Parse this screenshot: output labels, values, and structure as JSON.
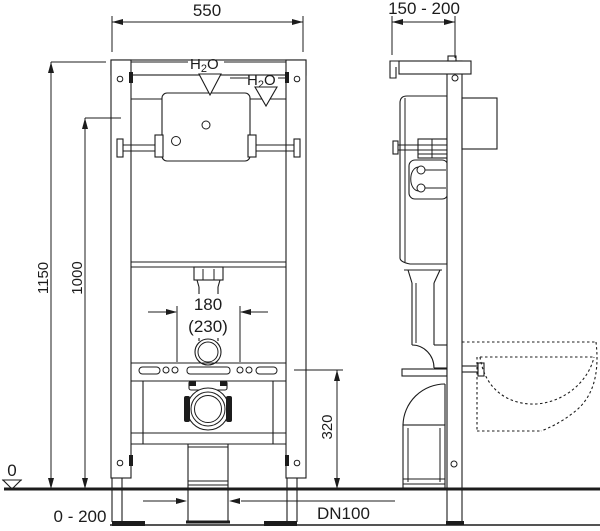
{
  "meta": {
    "title": "Wall-mounted WC concealed installation frame - dimensioned technical drawing (front and side view)"
  },
  "colors": {
    "line": "#1c1c1c",
    "background": "#ffffff"
  },
  "labels": {
    "front_width": "550",
    "side_depth": "150 - 200",
    "frame_height": "1150",
    "upper_fixing_height": "1000",
    "bolt_spacing": "180",
    "bolt_spacing_alt": "(230)",
    "drain_height": "320",
    "floor_level": "0",
    "leg_adjustment": "0 - 200",
    "drain_diameter": "DN100",
    "water": {
      "h": "H",
      "sub": "2",
      "o": "O"
    }
  }
}
